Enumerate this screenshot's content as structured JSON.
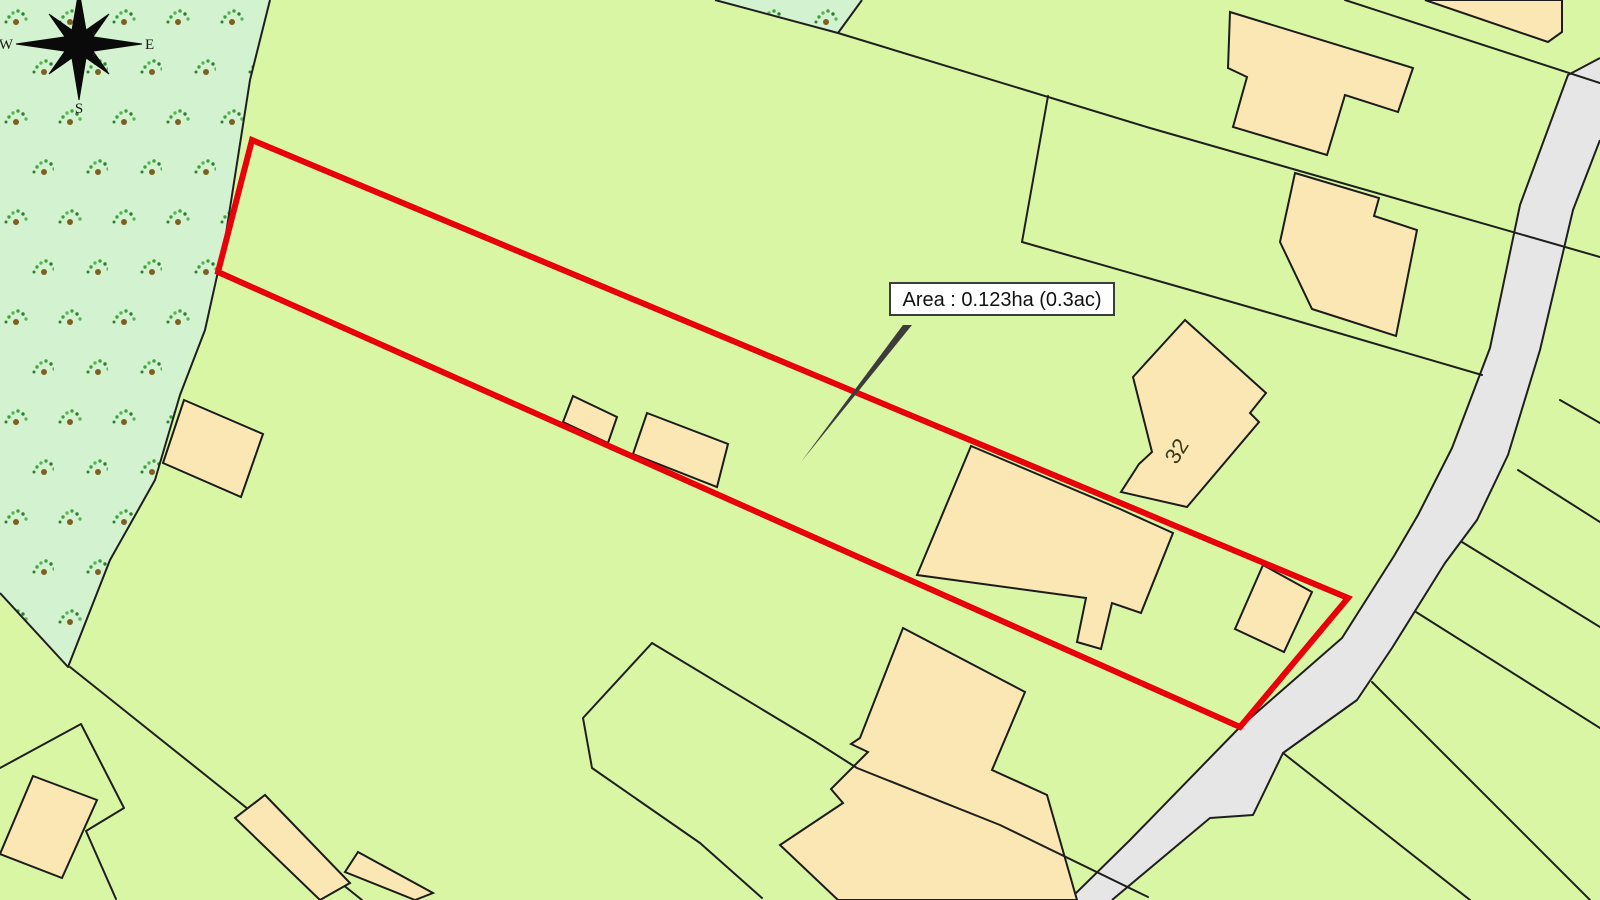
{
  "map": {
    "area_label": "Area : 0.123ha (0.3ac)",
    "house_number": "32",
    "compass": {
      "west": "W",
      "east": "E",
      "south": "S"
    },
    "colors": {
      "field_green": "#d9f6a5",
      "woodland_green": "#d3f2cf",
      "building_tan": "#fbe7b3",
      "road_grey": "#e6e6e6",
      "boundary_black": "#1f1f1f",
      "plot_outline_red": "#e8000b",
      "label_background": "#ffffff",
      "label_border": "#3c3c3c"
    }
  }
}
